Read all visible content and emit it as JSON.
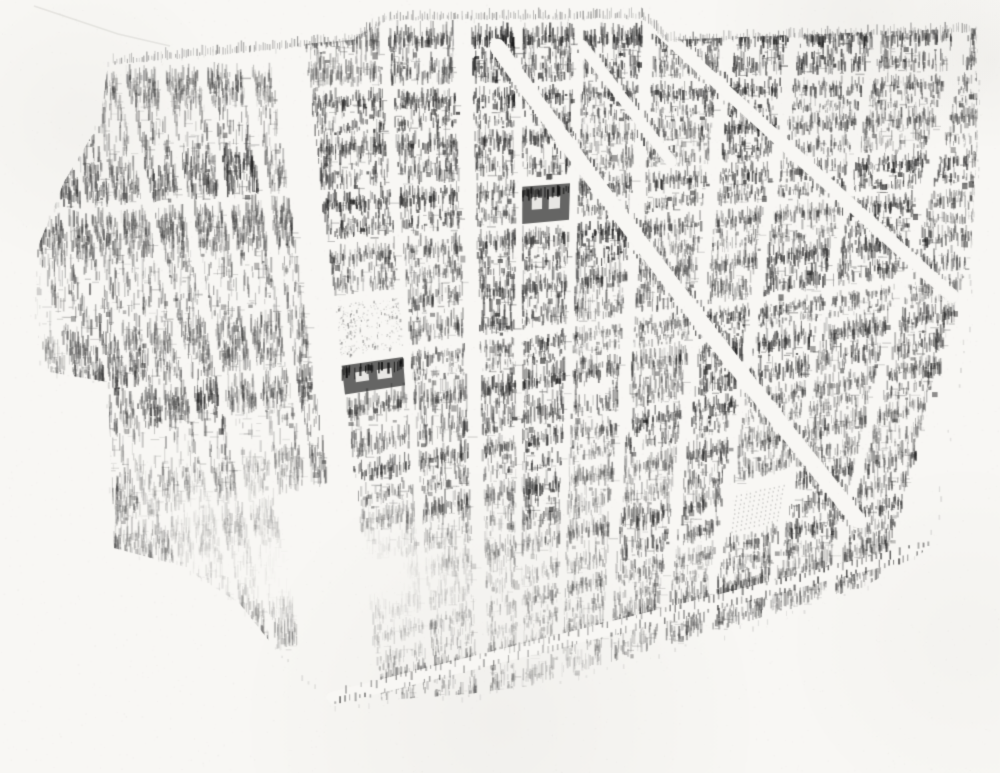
{
  "meta": {
    "description": "Hand-drawn pencil sketch: bird's-eye view map of a dense city street grid on white paper, fading out toward the lower left. No text or labels are visible."
  },
  "map": {
    "canvas": {
      "width": 1000,
      "height": 773,
      "seed": 1337
    },
    "colors": {
      "paper": "#f8f7f4",
      "ink_dark": "#1c1c1c",
      "ink_mid": "#5a5a5a",
      "ink_light": "#9c9a96"
    },
    "paper": {
      "noise_dots": 2600,
      "shade_blobs": [
        {
          "c": [
            500,
            722
          ],
          "r": 260,
          "a": 0.05
        },
        {
          "c": [
            80,
            120
          ],
          "r": 150,
          "a": 0.04
        },
        {
          "c": [
            965,
            640
          ],
          "r": 180,
          "a": 0.03
        },
        {
          "c": [
            860,
            22
          ],
          "r": 150,
          "a": 0.05
        },
        {
          "c": [
            990,
            60
          ],
          "r": 90,
          "a": 0.05
        }
      ],
      "crease": [
        [
          34,
          6
        ],
        [
          118,
          34
        ],
        [
          170,
          46
        ]
      ]
    },
    "outline": [
      [
        108,
        64
      ],
      [
        210,
        52
      ],
      [
        352,
        40
      ],
      [
        385,
        18
      ],
      [
        645,
        14
      ],
      [
        668,
        40
      ],
      [
        976,
        28
      ],
      [
        978,
        130
      ],
      [
        966,
        332
      ],
      [
        948,
        442
      ],
      [
        930,
        548
      ],
      [
        862,
        588
      ],
      [
        700,
        642
      ],
      [
        560,
        682
      ],
      [
        468,
        694
      ],
      [
        332,
        704
      ],
      [
        286,
        662
      ],
      [
        240,
        604
      ],
      [
        182,
        566
      ],
      [
        114,
        548
      ],
      [
        108,
        382
      ],
      [
        38,
        370
      ],
      [
        36,
        252
      ],
      [
        64,
        182
      ],
      [
        100,
        122
      ]
    ],
    "grid": {
      "vp_vertical": [
        520,
        1900
      ],
      "vp_horizontal": [
        2750,
        25
      ],
      "courtyard_ratio": 0.2,
      "districts": [
        {
          "name": "left",
          "x_range": [
            34,
            322
          ],
          "y_range": [
            58,
            660
          ],
          "v_spacing": 30,
          "h_spacing": 120,
          "v_width": [
            5,
            9
          ],
          "h_width": [
            6,
            10
          ]
        },
        {
          "name": "main",
          "x_range": [
            322,
            1004
          ],
          "y_range": [
            26,
            718
          ],
          "v_spacing": 58,
          "h_spacing": 47,
          "v_width": [
            6,
            12
          ],
          "h_width": [
            6,
            11
          ]
        }
      ],
      "avenues": [
        {
          "district": "main",
          "axis": "v",
          "near": 490,
          "width": 15
        },
        {
          "district": "main",
          "axis": "v",
          "near": 700,
          "width": 12
        },
        {
          "district": "main",
          "axis": "v",
          "near": 872,
          "width": 12
        },
        {
          "district": "main",
          "axis": "h",
          "near": 212,
          "width": 12
        },
        {
          "district": "main",
          "axis": "h",
          "near": 358,
          "width": 11
        },
        {
          "district": "main",
          "axis": "h",
          "near": 478,
          "width": 10
        },
        {
          "district": "left",
          "axis": "h",
          "near": 260,
          "width": 12
        }
      ]
    },
    "diagonals": [
      {
        "from": [
          497,
          46
        ],
        "mid": [
          640,
          250
        ],
        "to": [
          858,
          520
        ],
        "width": 15
      },
      {
        "from": [
          583,
          46
        ],
        "mid": [
          627,
          104
        ],
        "to": [
          672,
          162
        ],
        "width": 10
      },
      {
        "from": [
          658,
          28
        ],
        "mid": [
          800,
          160
        ],
        "to": [
          952,
          296
        ],
        "width": 12
      },
      {
        "from": [
          930,
          548
        ],
        "mid": [
          640,
          622
        ],
        "to": [
          332,
          698
        ],
        "width": 13
      }
    ],
    "landmarks": [
      [
        530,
        212
      ],
      [
        368,
        358
      ]
    ],
    "parks": [
      {
        "c": [
          392,
          302
        ],
        "style": "scatter"
      },
      {
        "c": [
          240,
          336
        ],
        "style": "scatter"
      },
      {
        "c": [
          742,
          492
        ],
        "style": "grid"
      }
    ],
    "fade": {
      "blobs": [
        {
          "c": [
            340,
            577
          ],
          "r": [
            265,
            100
          ],
          "k": 1.25
        },
        {
          "c": [
            205,
            505
          ],
          "r": [
            165,
            95
          ],
          "k": 0.7
        },
        {
          "c": [
            520,
            645
          ],
          "r": [
            205,
            75
          ],
          "k": 0.55
        },
        {
          "c": [
            205,
            95
          ],
          "r": [
            175,
            85
          ],
          "k": 0.5
        },
        {
          "c": [
            60,
            300
          ],
          "r": [
            70,
            180
          ],
          "k": 0.45
        }
      ],
      "bottom_y": 645
    },
    "fringe": {
      "path": [
        [
          112,
          62
        ],
        [
          352,
          40
        ],
        [
          386,
          18
        ],
        [
          642,
          16
        ],
        [
          668,
          40
        ],
        [
          972,
          30
        ]
      ],
      "step": 2.4
    }
  }
}
